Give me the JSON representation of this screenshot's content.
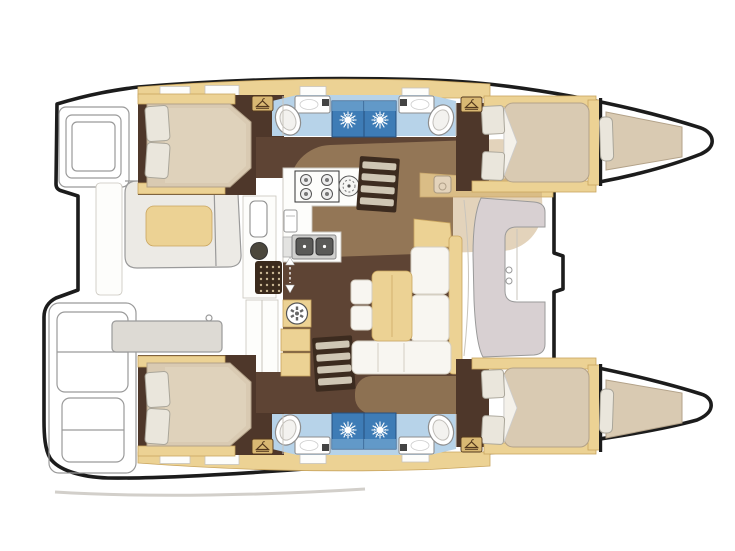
{
  "document": {
    "type": "catamaran-interior-floorplan",
    "view": "top-down deck plan",
    "orientation": "bow-right-stern-left",
    "hulls": [
      "port-hull-top",
      "starboard-hull-bottom"
    ]
  },
  "rooms": {
    "aft_cabin_port": "Aft double cabin (port)",
    "aft_cabin_starboard": "Aft double cabin (starboard)",
    "forward_cabin_port": "Forward double cabin (port)",
    "forward_cabin_starboard": "Forward double cabin (starboard)",
    "bathrooms": "Four bathrooms with separate shower stalls",
    "bow_berths": "Two bow berths",
    "salon": "Salon with L-shaped sofa, table and stools",
    "galley": "Galley with 4-burner stove, round hob and double sink",
    "cockpit": "Aft cockpit with bench, cushion and table",
    "forward_seat": "Forward cockpit C-shaped seat",
    "stern_steps": "Transom steps on both hulls"
  },
  "icons": [
    "shower-sun-icon",
    "wardrobe-hanger-icon",
    "toilet-icon",
    "washbasin-icon",
    "stove-burners-icon",
    "round-hob-icon",
    "double-sink-icon",
    "oven-icon",
    "washing-machine-icon",
    "floor-grating-icon",
    "companionway-arrows-icon",
    "stairs-icon",
    "deck-hatch-icon",
    "nav-sink-icon"
  ],
  "colors": {
    "outline": "#1c1c1c",
    "floor-cabin": "#4e372a",
    "floor-salon": "#5e4434",
    "overlay": "#c8a878",
    "joinery": "#ecd294",
    "joinery-dark": "#c9a55f",
    "joinery-pale": "#f0dfb8",
    "bed": "#d9cab2",
    "bed-edge": "#b3a289",
    "pillow": "#eae6dc",
    "pillow-edge": "#aaa69a",
    "bath-floor": "#b7d3e9",
    "shower": "#3e7cb6",
    "shower-light": "#6fa3cd",
    "shower-dark": "#274f7e",
    "fixture-edge": "#8e8e8e",
    "sink-dark": "#5a5a58",
    "steel": "#cfcfcd",
    "ext-line": "#9a9a9a",
    "ext-fill": "#eceae5",
    "seat-mauve": "#d8d0d2",
    "stair-dark": "#3c2b1f",
    "stair-tread": "#cfc6b4",
    "grid-dark": "#3a2a1c",
    "hanger-bg": "#d9b873",
    "hanger-glyph": "#54391e",
    "faint": "#c9c5bd",
    "shadow": "#d2cfca"
  }
}
